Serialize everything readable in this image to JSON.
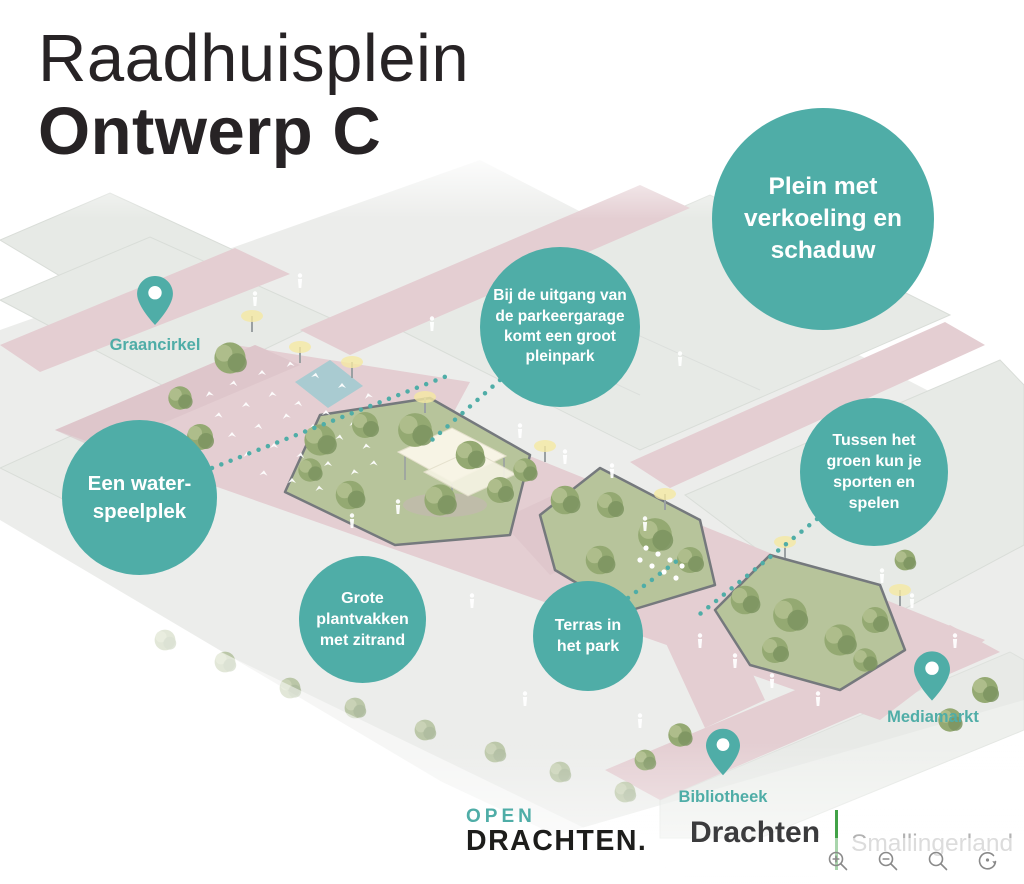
{
  "title": {
    "line1": "Raadhuisplein",
    "line2": "Ontwerp C"
  },
  "callouts": {
    "plein": {
      "text": "Plein met verkoeling en schaduw"
    },
    "uitgang": {
      "text": "Bij de uitgang van de parkeergarage komt een groot pleinpark"
    },
    "tussen": {
      "text": "Tussen het groen kun je sporten en spelen"
    },
    "water": {
      "text": "Een water-speelplek"
    },
    "plantvakken": {
      "text": "Grote plantvakken met zitrand"
    },
    "terras": {
      "text": "Terras in het park"
    }
  },
  "pins": {
    "graancirkel": {
      "label": "Graancirkel"
    },
    "mediamarkt": {
      "label": "Mediamarkt"
    },
    "bibliotheek": {
      "label": "Bibliotheek"
    }
  },
  "footer": {
    "open_drachten": {
      "top": "OPEN",
      "bottom": "DRACHTEN."
    },
    "municipality": {
      "name": "Drachten",
      "region": "Smallingerland"
    }
  },
  "viewer": {
    "icons": [
      "zoom-in",
      "zoom-out",
      "search",
      "reset"
    ]
  },
  "colors": {
    "teal": "#4FADA7",
    "ink": "#272325",
    "pink": "#e4ced2",
    "pinkdeep": "#d9bfc5",
    "ground": "#ecedeb",
    "roof": "#e7eae6",
    "roofline": "#d9ddd8",
    "parkbase": "#b7c49b",
    "treedark": "#7d9460",
    "treemid": "#94a972",
    "treelight": "#b3c18f",
    "water": "#a2cbd0",
    "canopy": "#f7f4e5",
    "glow": "#f5e8a3",
    "wall": "#75797d",
    "logoink": "#1d1d1b",
    "logodark": "#3b3b3d",
    "logogreen": "#41a247",
    "logogray": "#b2b2b2",
    "icongray": "#8a8a8a"
  }
}
